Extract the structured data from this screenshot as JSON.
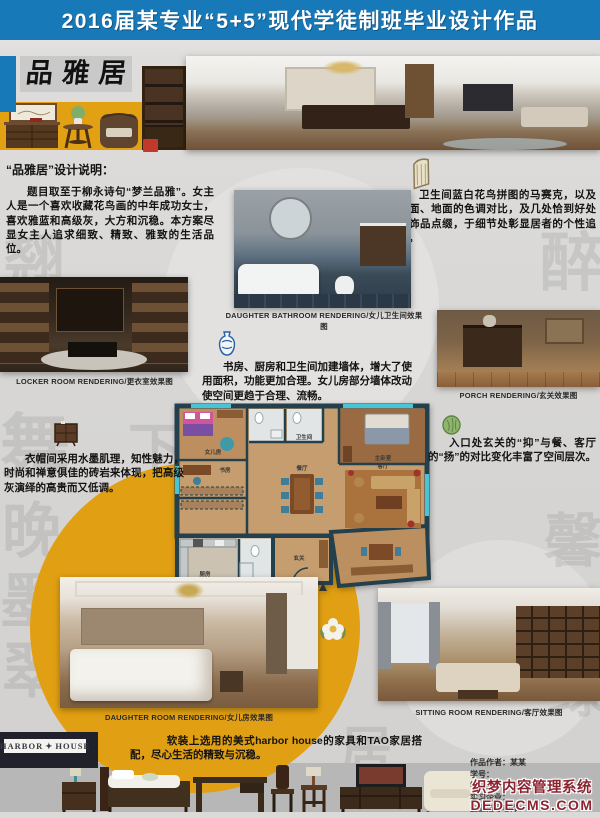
{
  "banner": {
    "title": "2016届某专业“5+5”现代学徒制班毕业设计作品"
  },
  "masthead": {
    "title": "品 雅 居"
  },
  "notes": {
    "design": {
      "heading": "“品雅居”设计说明：",
      "body": "题目取至于柳永诗句“梦兰品雅”。女主人是一个喜欢收藏花鸟画的中年成功女士，喜欢雅蓝和高级灰，大方和沉稳。本方案尽显女主人追求细致、精致、雅致的生活品位。"
    },
    "bathroom": "卫生间蓝白花鸟拼图的马赛克，以及墙面、地面的色调对比，及几处恰到好处的饰品点缀，于细节处彰显居者的个性追求。",
    "walls": "书房、厨房和卫生间加建墙体，增大了使用面积，功能更加合理。女儿房部分墙体改动使空间更趋于合理、流畅。",
    "porch": "入口处玄关的“抑”与餐、客厅的“扬”的对比变化丰富了空间层次。",
    "cloakroom": "衣帽间采用水墨肌理，知性魅力，时尚和禅意俱佳的砖岩来体现，把高级灰演绎的高贵而又低调。",
    "furnishing": "软装上选用的美式harbor house的家具和TAO家居搭配，尽心生活的精致与沉稳。"
  },
  "renderings": {
    "bathroom": {
      "label": "DAUGHTER BATHROOM RENDERING/女儿卫生间效果图"
    },
    "locker": {
      "label": "LOCKER ROOM RENDERING/更衣室效果图"
    },
    "porch": {
      "label": "PORCH RENDERING/玄关效果图"
    },
    "daughter": {
      "label": "DAUGHTER ROOM RENDERING/女儿房效果图"
    },
    "sitting": {
      "label": "SITTING ROOM RENDERING/客厅效果图"
    }
  },
  "floor_plan": {
    "rooms": {
      "daughter": "女儿房",
      "bath": "卫生间",
      "master": "主卧室",
      "study": "书房",
      "dining": "餐厅",
      "living": "客厅",
      "kitchen": "厨房",
      "porch": "玄关"
    }
  },
  "logo": {
    "name": "HARBOR HOUSE",
    "left": "HARBOR",
    "right": "HOUSE"
  },
  "credits": {
    "author": "作品作者：某某",
    "student_id": "学号：",
    "school_tutor": "学校指导老师：",
    "intern_company": "实习企业：",
    "company_tutor": "企业指导老师："
  },
  "watermark": {
    "line1": "织梦内容管理系统",
    "line2": "DEDECMS.COM"
  },
  "decor": {
    "calligraphy": [
      "翘",
      "醉",
      "舞",
      "下",
      "晚",
      "墨",
      "翠",
      "馨",
      "蔓",
      "绿",
      "居"
    ]
  },
  "colors": {
    "banner_blue": "#1879b9",
    "band_yellow": "#e2a013",
    "bg_gray": "#d6d5d3",
    "strip_gray": "#b7b7b7",
    "logo_dark": "#20212a",
    "watermark_red": "#8b2430"
  }
}
